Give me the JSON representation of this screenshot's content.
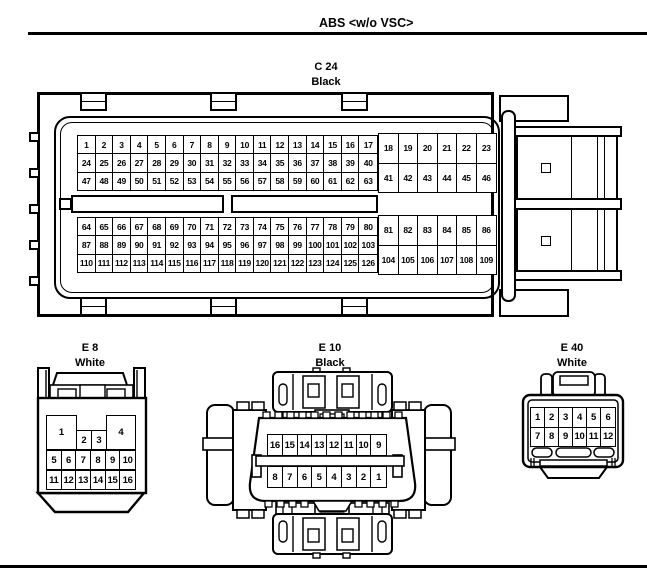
{
  "header": {
    "title": "ABS <w/o VSC>"
  },
  "colors": {
    "line": "#000000",
    "background": "#ffffff"
  },
  "connectors": {
    "c24": {
      "name": "C 24",
      "color": "Black",
      "grids": {
        "left_top": [
          [
            "1",
            "2",
            "3",
            "4",
            "5",
            "6",
            "7",
            "8",
            "9",
            "10",
            "11",
            "12",
            "13",
            "14",
            "15",
            "16",
            "17"
          ],
          [
            "24",
            "25",
            "26",
            "27",
            "28",
            "29",
            "30",
            "31",
            "32",
            "33",
            "34",
            "35",
            "36",
            "37",
            "38",
            "39",
            "40"
          ],
          [
            "47",
            "48",
            "49",
            "50",
            "51",
            "52",
            "53",
            "54",
            "55",
            "56",
            "57",
            "58",
            "59",
            "60",
            "61",
            "62",
            "63"
          ]
        ],
        "right_top": [
          [
            "18",
            "19",
            "20",
            "21",
            "22",
            "23"
          ],
          [
            "41",
            "42",
            "43",
            "44",
            "45",
            "46"
          ]
        ],
        "left_bottom": [
          [
            "64",
            "65",
            "66",
            "67",
            "68",
            "69",
            "70",
            "71",
            "72",
            "73",
            "74",
            "75",
            "76",
            "77",
            "78",
            "79",
            "80"
          ],
          [
            "87",
            "88",
            "89",
            "90",
            "91",
            "92",
            "93",
            "94",
            "95",
            "96",
            "97",
            "98",
            "99",
            "100",
            "101",
            "102",
            "103"
          ],
          [
            "110",
            "111",
            "112",
            "113",
            "114",
            "115",
            "116",
            "117",
            "118",
            "119",
            "120",
            "121",
            "122",
            "123",
            "124",
            "125",
            "126"
          ]
        ],
        "right_bottom": [
          [
            "81",
            "82",
            "83",
            "84",
            "85",
            "86"
          ],
          [
            "104",
            "105",
            "106",
            "107",
            "108",
            "109"
          ]
        ]
      }
    },
    "e8": {
      "name": "E 8",
      "color": "White",
      "row1": [
        "1",
        "2",
        "3",
        "4"
      ],
      "row2": [
        "5",
        "6",
        "7",
        "8",
        "9",
        "10"
      ],
      "row3": [
        "11",
        "12",
        "13",
        "14",
        "15",
        "16"
      ]
    },
    "e10": {
      "name": "E 10",
      "color": "Black",
      "row1": [
        "16",
        "15",
        "14",
        "13",
        "12",
        "11",
        "10",
        "9"
      ],
      "row2": [
        "8",
        "7",
        "6",
        "5",
        "4",
        "3",
        "2",
        "1"
      ]
    },
    "e40": {
      "name": "E 40",
      "color": "White",
      "rows": [
        [
          "1",
          "2",
          "3",
          "4",
          "5",
          "6"
        ],
        [
          "7",
          "8",
          "9",
          "10",
          "11",
          "12"
        ]
      ]
    }
  }
}
